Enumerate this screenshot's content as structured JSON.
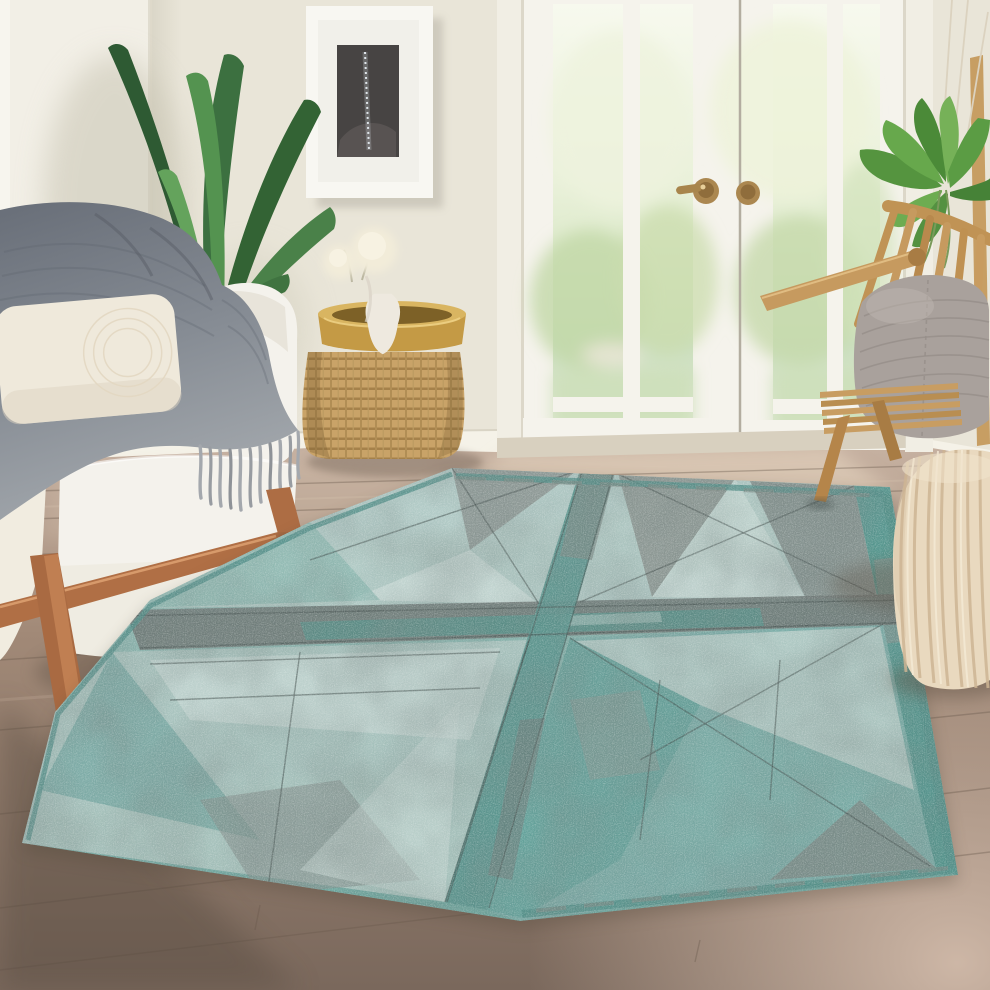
{
  "meta": {
    "domain": "natural-image",
    "no_onscreen_text": true,
    "title": "Living room lifestyle photo with teal geometric area rug"
  },
  "colors": {
    "wall": "#e9e5d8",
    "wallLeft": "#f2efe6",
    "trim": "#f5f2e8",
    "door": "#f5f3ec",
    "glassTop": "#f6f8ea",
    "garden": "#cfe3bf",
    "lawn": "#cde0ba",
    "brass": "#ab8750",
    "floorLight": "#c9b4a3",
    "floorMid": "#997f6f",
    "floorDark": "#77655a",
    "plankLine": "#6a5a4c",
    "sunPatch": "#ecdcc6",
    "sofa": "#f4f2ec",
    "sofaShade": "#e0dbce",
    "cushion": "#efe9db",
    "throwGray": "#7d838c",
    "throwLight": "#9ba1a7",
    "fringe": "#a4a8ad",
    "legWood": "#b06f45",
    "wicker": "#c9a368",
    "wickerDark": "#9a7843",
    "gold": "#c49a45",
    "goldLight": "#d9b561",
    "vase": "#eee9df",
    "flower": "#f2ecd9",
    "leafDark": "#2e5a33",
    "leafMid": "#3c7040",
    "leafLight": "#64a35c",
    "hangLeaf": "#55943f",
    "pole": "#c79e63",
    "frame": "#f8f7f2",
    "art": "#474443",
    "sparkle": "#cfd6dc",
    "oak": "#c69a5f",
    "oakDark": "#a87c44",
    "chairPillow": "#a9a19c",
    "pouf": "#e9d9bf",
    "poufRib": "#cdb493",
    "rugTeal": "#79aca6",
    "rugDeep": "#4f948c",
    "rugLight": "#b3cbc7",
    "rugPale": "#cfdeda",
    "rugGray": "#8b938f",
    "rugGrayDark": "#6d7774",
    "rugLine": "#3a4543",
    "rugBand": "#57948d",
    "shadow": "#5e5144"
  },
  "scene": {
    "alt": "Bright living room: white loveseat with gray fringed knit throw and cream pillow, tall green aspidistra plant, framed charcoal art print, wicker drum side table with brass tray and vase of cream flowers, white French patio doors with brass knobs opening to a sunlit garden, rattan slat chair with gray knit cushion, hanging green plant, cream knitted pouf, and a large distressed teal-and-gray geometric patchwork rug over warm wood plank flooring.",
    "room": {
      "label": "room shell",
      "wall_finish": "warm off-white painted walls with corner at left",
      "baseboard": "white baseboard trim",
      "floor": "wide warm-taupe wood planks, lighter near the doors and front right, darker at front left"
    },
    "artwork": {
      "label": "framed art print",
      "frame": "white gallery frame with wide white mat",
      "subject": "charcoal abstract with a vertical sparkling streak"
    },
    "doors": {
      "label": "French patio doors",
      "style": "white double doors, two tall glass lites over a short bottom lite each",
      "hardware": "round brass knobs",
      "view": "sunlit garden with bright shrubs and green lawn"
    },
    "plants": [
      {
        "label": "aspidistra floor plant",
        "position": "corner behind loveseat"
      },
      {
        "label": "hanging trailing plant",
        "position": "upper right beside doors, with wood pole and hanger cords"
      }
    ],
    "furniture": [
      {
        "label": "white loveseat",
        "details": "ivory upholstery, angled wood legs and front rail",
        "accessories": [
          "gray chunky-knit fringed throw",
          "cream lumbar pillow"
        ]
      },
      {
        "label": "wicker drum side table",
        "details": "woven rattan drum base with round brass tray top",
        "accessories": [
          "white ceramic vase",
          "cream pom flowers"
        ]
      },
      {
        "label": "rattan slat chair",
        "details": "angled oak frame, slatted seat and back",
        "accessories": [
          "gray knit lumbar cushion"
        ]
      },
      {
        "label": "knitted pouf",
        "details": "cream ribbed knit, barrel shape"
      }
    ],
    "rug": {
      "label": "area rug",
      "style": "distressed geometric patchwork",
      "pattern": "grid of large squares split into pinwheel triangles with gray and teal cross bands and thin sketch lines",
      "palette": [
        "teal",
        "seafoam",
        "slate gray",
        "ivory"
      ],
      "texture": "eroded, heathered flat-weave look"
    }
  }
}
